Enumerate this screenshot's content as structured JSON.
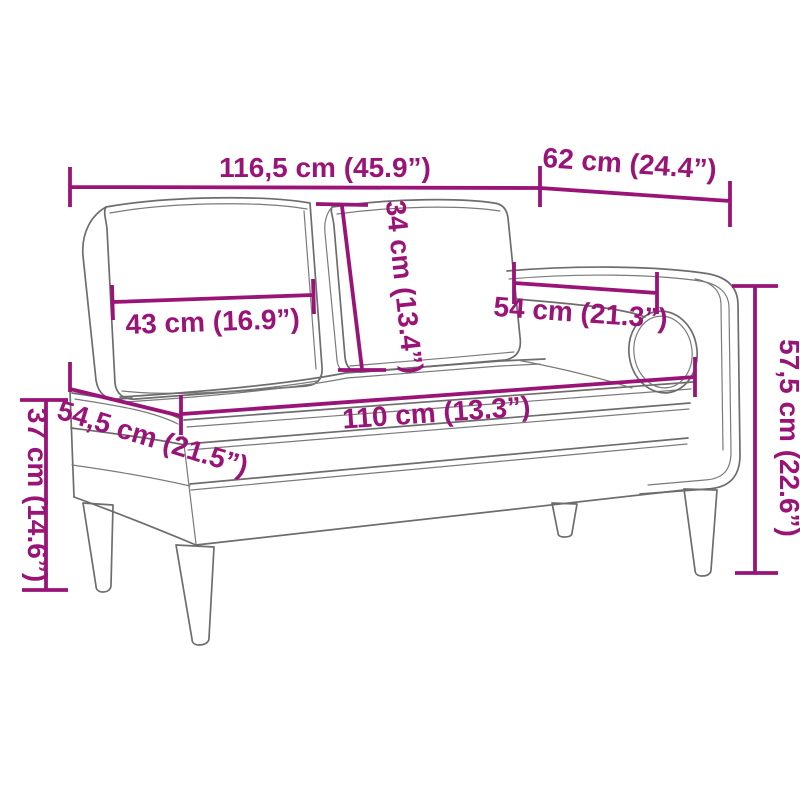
{
  "diagram": {
    "title": "chaise-lounge-dimension-diagram",
    "product": "chaise lounge with cushions and bolster",
    "colors": {
      "accent": "#9a1478",
      "line": "#6d6d6d",
      "background": "#ffffff"
    },
    "dimensions": {
      "total_width": "116,5 cm (45.9”)",
      "armrest_width": "62 cm (24.4”)",
      "back_cushion_height": "34 cm (13.4”)",
      "left_cushion_width": "43 cm (16.9”)",
      "right_cushion_width": "54 cm (21.3”)",
      "seat_length": "110 cm (13.3”)",
      "seat_depth": "54,5 cm (21.5”)",
      "leg_height": "37 cm (14.6”)",
      "total_height": "57,5 cm (22.6”)"
    }
  }
}
